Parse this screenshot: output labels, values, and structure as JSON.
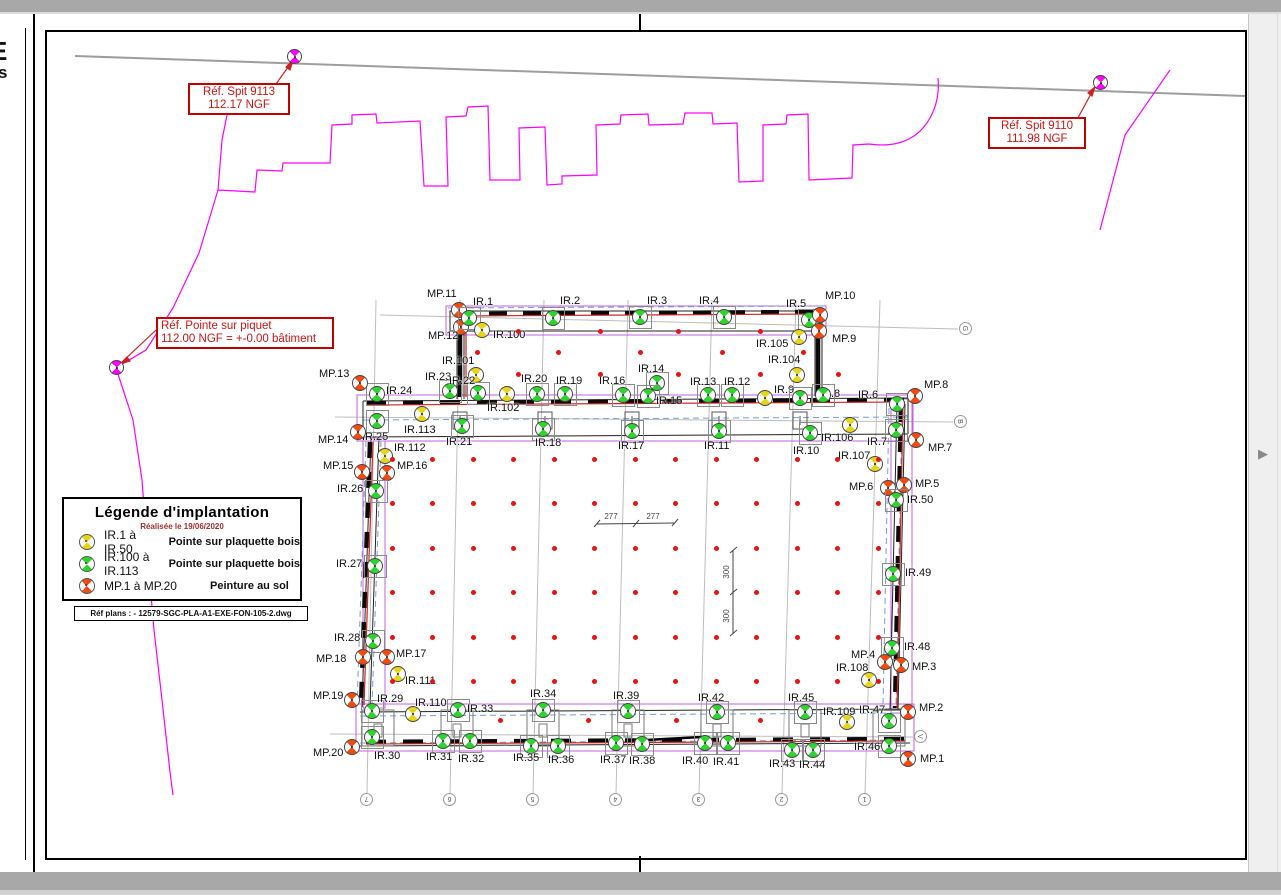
{
  "colors": {
    "ir_yellow": "#e6d51d",
    "ir_green": "#2fd32f",
    "mp_red": "#f14a12",
    "ref_magenta": "#ff00ff",
    "dot_red": "#e81212",
    "annotation_red": "#c00000",
    "wall_red": "#cc2222",
    "outline_purple": "#c55fe0",
    "dash_blue": "#7b9cd0"
  },
  "annotations": {
    "spit9113": {
      "line1": "Réf. Spit 9113",
      "line2": "112.17 NGF"
    },
    "spit9110": {
      "line1": "Réf. Spit 9110",
      "line2": "111.98 NGF"
    },
    "piquet": {
      "line1": "Réf. Pointe sur piquet",
      "line2": "112.00 NGF = +-0.00 bâtiment"
    }
  },
  "legend": {
    "title": "Légende d'implantation",
    "subtitle": "Réalisée le 19/06/2020",
    "rows": [
      {
        "marker": "yellow",
        "range": "IR.1 à IR.50",
        "desc": "Pointe sur plaquette bois"
      },
      {
        "marker": "green",
        "range": "IR.100 à IR.113",
        "desc": "Pointe sur plaquette bois"
      },
      {
        "marker": "red",
        "range": "MP.1 à MP.20",
        "desc": "Peinture au sol"
      }
    ],
    "ref_plan": "Réf plans : - 12579-SGC-PLA-A1-EXE-FON-105-2.dwg"
  },
  "left_sheet_fragments": [
    "E",
    "s"
  ],
  "dimensions": {
    "h": [
      "277",
      "277"
    ],
    "v": [
      "300",
      "300"
    ]
  },
  "grid_bubbles": {
    "bottom": [
      "7",
      "6",
      "5",
      "4",
      "3",
      "2",
      "1"
    ],
    "right": [
      "G",
      "B",
      "V"
    ]
  },
  "pager": {
    "arrow": "▶"
  },
  "markers": [
    {
      "l": "",
      "t": "ref",
      "x": 295,
      "y": 57
    },
    {
      "l": "",
      "t": "ref",
      "x": 1101,
      "y": 83
    },
    {
      "l": "",
      "t": "ref",
      "x": 117,
      "y": 368
    },
    {
      "l": "MP.11",
      "t": "mp",
      "x": 459,
      "y": 310,
      "tx": 427,
      "ty": 289
    },
    {
      "l": "MP.12",
      "t": "mp",
      "x": 461,
      "y": 327,
      "tx": 428,
      "ty": 331
    },
    {
      "l": "IR.1",
      "t": "g",
      "x": 469,
      "y": 318,
      "tx": 473,
      "ty": 297
    },
    {
      "l": "IR.100",
      "t": "y",
      "x": 482,
      "y": 330,
      "tx": 493,
      "ty": 330
    },
    {
      "l": "IR.2",
      "t": "g",
      "x": 553,
      "y": 318,
      "tx": 560,
      "ty": 296
    },
    {
      "l": "IR.3",
      "t": "g",
      "x": 640,
      "y": 317,
      "tx": 647,
      "ty": 296
    },
    {
      "l": "IR.4",
      "t": "g",
      "x": 724,
      "y": 317,
      "tx": 699,
      "ty": 296
    },
    {
      "l": "IR.5",
      "t": "g",
      "x": 809,
      "y": 320,
      "tx": 786,
      "ty": 299
    },
    {
      "l": "MP.10",
      "t": "mp",
      "x": 820,
      "y": 315,
      "tx": 825,
      "ty": 291
    },
    {
      "l": "MP.9",
      "t": "mp",
      "x": 819,
      "y": 331,
      "tx": 832,
      "ty": 334
    },
    {
      "l": "IR.105",
      "t": "y",
      "x": 799,
      "y": 337,
      "tx": 756,
      "ty": 339
    },
    {
      "l": "IR.104",
      "t": "y",
      "x": 797,
      "y": 375,
      "tx": 768,
      "ty": 355
    },
    {
      "l": "IR.101",
      "t": "y",
      "x": 476,
      "y": 375,
      "tx": 442,
      "ty": 356
    },
    {
      "l": "IR.24",
      "t": "g",
      "x": 377,
      "y": 394,
      "tx": 386,
      "ty": 386
    },
    {
      "l": "IR.23",
      "t": "g",
      "x": 450,
      "y": 391,
      "tx": 425,
      "ty": 372
    },
    {
      "l": "IR.22",
      "t": "g",
      "x": 478,
      "y": 393,
      "tx": 449,
      "ty": 376
    },
    {
      "l": "IR.102",
      "t": "y",
      "x": 507,
      "y": 394,
      "tx": 487,
      "ty": 403
    },
    {
      "l": "IR.20",
      "t": "g",
      "x": 537,
      "y": 394,
      "tx": 521,
      "ty": 374
    },
    {
      "l": "IR.19",
      "t": "g",
      "x": 565,
      "y": 394,
      "tx": 556,
      "ty": 376
    },
    {
      "l": "IR.16",
      "t": "g",
      "x": 623,
      "y": 395,
      "tx": 599,
      "ty": 376
    },
    {
      "l": "IR.14",
      "t": "g",
      "x": 657,
      "y": 383,
      "tx": 638,
      "ty": 364
    },
    {
      "l": "IR.15",
      "t": "g",
      "x": 648,
      "y": 396,
      "tx": 656,
      "ty": 396
    },
    {
      "l": "IR.13",
      "t": "g",
      "x": 708,
      "y": 395,
      "tx": 690,
      "ty": 377
    },
    {
      "l": "IR.12",
      "t": "g",
      "x": 732,
      "y": 395,
      "tx": 724,
      "ty": 377
    },
    {
      "l": "IR.9",
      "t": "y",
      "x": 765,
      "y": 398,
      "tx": 774,
      "ty": 385
    },
    {
      "l": "IR.8",
      "t": "g",
      "x": 800,
      "y": 398,
      "tx": 820,
      "ty": 389
    },
    {
      "l": "",
      "t": "g",
      "x": 823,
      "y": 395
    },
    {
      "l": "IR.6",
      "t": "g",
      "x": 897,
      "y": 404,
      "tx": 858,
      "ty": 390
    },
    {
      "l": "MP.8",
      "t": "mp",
      "x": 915,
      "y": 396,
      "tx": 924,
      "ty": 380
    },
    {
      "l": "MP.7",
      "t": "mp",
      "x": 916,
      "y": 440,
      "tx": 928,
      "ty": 443
    },
    {
      "l": "IR.25",
      "t": "g",
      "x": 377,
      "y": 421,
      "tx": 362,
      "ty": 432
    },
    {
      "l": "IR.113",
      "t": "y",
      "x": 422,
      "y": 414,
      "tx": 404,
      "ty": 425
    },
    {
      "l": "IR.21",
      "t": "g",
      "x": 462,
      "y": 426,
      "tx": 446,
      "ty": 437
    },
    {
      "l": "IR.18",
      "t": "g",
      "x": 543,
      "y": 429,
      "tx": 535,
      "ty": 438
    },
    {
      "l": "IR.17",
      "t": "g",
      "x": 632,
      "y": 431,
      "tx": 618,
      "ty": 441
    },
    {
      "l": "IR.11",
      "t": "g",
      "x": 719,
      "y": 431,
      "tx": 704,
      "ty": 441
    },
    {
      "l": "IR.10",
      "t": "g",
      "x": 810,
      "y": 433,
      "tx": 793,
      "ty": 446
    },
    {
      "l": "IR.106",
      "t": "y",
      "x": 850,
      "y": 425,
      "tx": 821,
      "ty": 433
    },
    {
      "l": "IR.7",
      "t": "g",
      "x": 896,
      "y": 430,
      "tx": 867,
      "ty": 437
    },
    {
      "l": "IR.107",
      "t": "y",
      "x": 875,
      "y": 464,
      "tx": 838,
      "ty": 451
    },
    {
      "l": "MP.6",
      "t": "mp",
      "x": 888,
      "y": 488,
      "tx": 849,
      "ty": 482
    },
    {
      "l": "MP.5",
      "t": "mp",
      "x": 904,
      "y": 485,
      "tx": 915,
      "ty": 479
    },
    {
      "l": "IR.50",
      "t": "g",
      "x": 896,
      "y": 500,
      "tx": 907,
      "ty": 495
    },
    {
      "l": "IR.49",
      "t": "g",
      "x": 893,
      "y": 574,
      "tx": 905,
      "ty": 568
    },
    {
      "l": "IR.48",
      "t": "g",
      "x": 892,
      "y": 648,
      "tx": 904,
      "ty": 642
    },
    {
      "l": "MP.4",
      "t": "mp",
      "x": 885,
      "y": 662,
      "tx": 851,
      "ty": 650
    },
    {
      "l": "MP.3",
      "t": "mp",
      "x": 901,
      "y": 665,
      "tx": 912,
      "ty": 662
    },
    {
      "l": "IR.108",
      "t": "y",
      "x": 869,
      "y": 680,
      "tx": 836,
      "ty": 663
    },
    {
      "l": "MP.13",
      "t": "mp",
      "x": 360,
      "y": 383,
      "tx": 319,
      "ty": 369
    },
    {
      "l": "MP.14",
      "t": "mp",
      "x": 358,
      "y": 432,
      "tx": 318,
      "ty": 435
    },
    {
      "l": "MP.15",
      "t": "mp",
      "x": 362,
      "y": 472,
      "tx": 323,
      "ty": 461
    },
    {
      "l": "MP.16",
      "t": "mp",
      "x": 387,
      "y": 473,
      "tx": 397,
      "ty": 461
    },
    {
      "l": "IR.26",
      "t": "g",
      "x": 376,
      "y": 491,
      "tx": 337,
      "ty": 484
    },
    {
      "l": "IR.112",
      "t": "y",
      "x": 385,
      "y": 456,
      "tx": 394,
      "ty": 443
    },
    {
      "l": "IR.27",
      "t": "g",
      "x": 375,
      "y": 566,
      "tx": 336,
      "ty": 559
    },
    {
      "l": "IR.28",
      "t": "g",
      "x": 373,
      "y": 641,
      "tx": 334,
      "ty": 633
    },
    {
      "l": "MP.18",
      "t": "mp",
      "x": 363,
      "y": 657,
      "tx": 316,
      "ty": 654
    },
    {
      "l": "MP.17",
      "t": "mp",
      "x": 387,
      "y": 657,
      "tx": 396,
      "ty": 649
    },
    {
      "l": "IR.111",
      "t": "y",
      "x": 398,
      "y": 674,
      "tx": 405,
      "ty": 676
    },
    {
      "l": "MP.19",
      "t": "mp",
      "x": 352,
      "y": 700,
      "tx": 313,
      "ty": 691
    },
    {
      "l": "MP.20",
      "t": "mp",
      "x": 352,
      "y": 747,
      "tx": 313,
      "ty": 748
    },
    {
      "l": "IR.29",
      "t": "g",
      "x": 372,
      "y": 711,
      "tx": 377,
      "ty": 694
    },
    {
      "l": "IR.110",
      "t": "y",
      "x": 413,
      "y": 714,
      "tx": 415,
      "ty": 698
    },
    {
      "l": "IR.33",
      "t": "g",
      "x": 458,
      "y": 710,
      "tx": 467,
      "ty": 704
    },
    {
      "l": "IR.34",
      "t": "g",
      "x": 543,
      "y": 710,
      "tx": 530,
      "ty": 689
    },
    {
      "l": "IR.39",
      "t": "g",
      "x": 628,
      "y": 711,
      "tx": 613,
      "ty": 691
    },
    {
      "l": "IR.30",
      "t": "g",
      "x": 372,
      "y": 737,
      "tx": 374,
      "ty": 751
    },
    {
      "l": "IR.31",
      "t": "g",
      "x": 443,
      "y": 741,
      "tx": 426,
      "ty": 752
    },
    {
      "l": "IR.32",
      "t": "g",
      "x": 470,
      "y": 741,
      "tx": 458,
      "ty": 754
    },
    {
      "l": "IR.35",
      "t": "g",
      "x": 531,
      "y": 746,
      "tx": 513,
      "ty": 753
    },
    {
      "l": "IR.36",
      "t": "g",
      "x": 558,
      "y": 746,
      "tx": 548,
      "ty": 755
    },
    {
      "l": "IR.37",
      "t": "g",
      "x": 616,
      "y": 743,
      "tx": 600,
      "ty": 755
    },
    {
      "l": "IR.38",
      "t": "g",
      "x": 642,
      "y": 744,
      "tx": 629,
      "ty": 756
    },
    {
      "l": "IR.42",
      "t": "g",
      "x": 717,
      "y": 712,
      "tx": 698,
      "ty": 693
    },
    {
      "l": "IR.45",
      "t": "g",
      "x": 805,
      "y": 712,
      "tx": 788,
      "ty": 693
    },
    {
      "l": "IR.109",
      "t": "y",
      "x": 847,
      "y": 722,
      "tx": 823,
      "ty": 707
    },
    {
      "l": "IR.47",
      "t": "g",
      "x": 889,
      "y": 721,
      "tx": 859,
      "ty": 705
    },
    {
      "l": "MP.2",
      "t": "mp",
      "x": 908,
      "y": 712,
      "tx": 919,
      "ty": 703
    },
    {
      "l": "IR.46",
      "t": "g",
      "x": 889,
      "y": 746,
      "tx": 854,
      "ty": 742
    },
    {
      "l": "MP.1",
      "t": "mp",
      "x": 908,
      "y": 759,
      "tx": 920,
      "ty": 754
    },
    {
      "l": "IR.40",
      "t": "g",
      "x": 705,
      "y": 743,
      "tx": 682,
      "ty": 756
    },
    {
      "l": "IR.41",
      "t": "g",
      "x": 728,
      "y": 743,
      "tx": 713,
      "ty": 757
    },
    {
      "l": "IR.43",
      "t": "g",
      "x": 792,
      "y": 750,
      "tx": 769,
      "ty": 759
    },
    {
      "l": "IR.44",
      "t": "g",
      "x": 813,
      "y": 750,
      "tx": 799,
      "ty": 760
    }
  ],
  "dots": {
    "cols_x": [
      392,
      432,
      473,
      513,
      554,
      594,
      635,
      675,
      716,
      756,
      797,
      837,
      878
    ],
    "rows_y": [
      459,
      503,
      548,
      592,
      637,
      681
    ],
    "sparse": [
      {
        "y": 331,
        "xs": [
          518,
          600,
          678,
          760
        ]
      },
      {
        "y": 352,
        "xs": [
          477,
          558,
          640,
          722,
          803
        ]
      },
      {
        "y": 374,
        "xs": [
          518,
          600,
          678,
          760,
          838
        ]
      },
      {
        "y": 720,
        "xs": [
          500,
          588,
          676,
          760
        ]
      }
    ]
  }
}
